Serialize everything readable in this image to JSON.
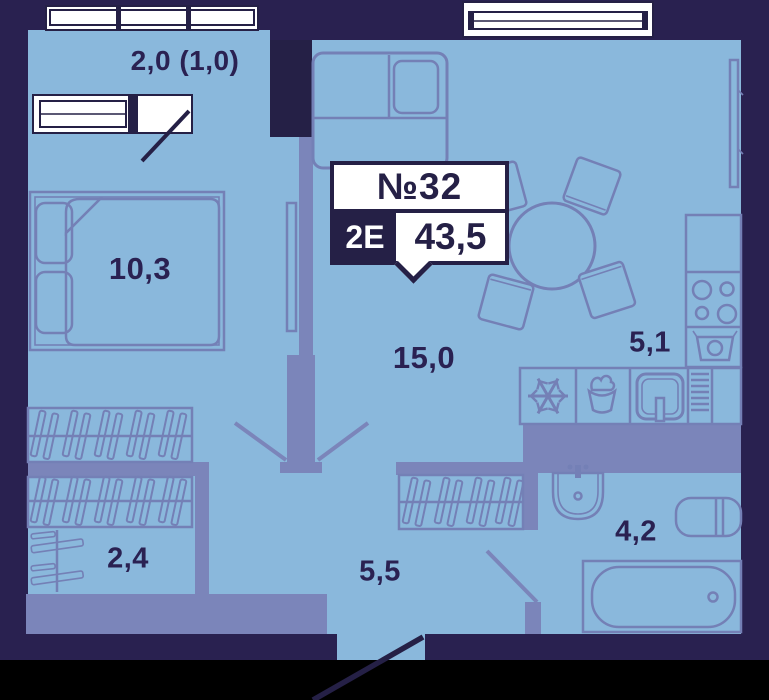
{
  "badge": {
    "number": "№32",
    "type": "2Е",
    "area": "43,5"
  },
  "rooms": {
    "balcony": {
      "area": "2,0 (1,0)"
    },
    "bedroom": {
      "area": "10,3"
    },
    "living": {
      "area": "15,0"
    },
    "kitchen": {
      "area": "5,1"
    },
    "wardrobe": {
      "area": "2,4"
    },
    "hallway": {
      "area": "5,5"
    },
    "bathroom": {
      "area": "4,2"
    }
  },
  "colors": {
    "outer_wall": "#292150",
    "floor": "#8ab8dc",
    "inner_wall": "#7b85ba",
    "furniture_line": "#7480b6",
    "label_text": "#2a2152",
    "badge_dark": "#252046",
    "window": "#ffffff",
    "page_background": "#000000"
  },
  "icons": {
    "fridge": "snowflake-icon",
    "cooktop": "burners-icon",
    "kitchen_sink": "sink-icon",
    "dish_dryer": "dryer-lines-icon",
    "wash_basin": "basin-icon",
    "toilet": "toilet-icon",
    "bathtub": "bathtub-icon",
    "wardrobe_storage": "hangers-icon",
    "entrance_direction": "down-arrow-icon",
    "door": "door-swing-icon"
  }
}
